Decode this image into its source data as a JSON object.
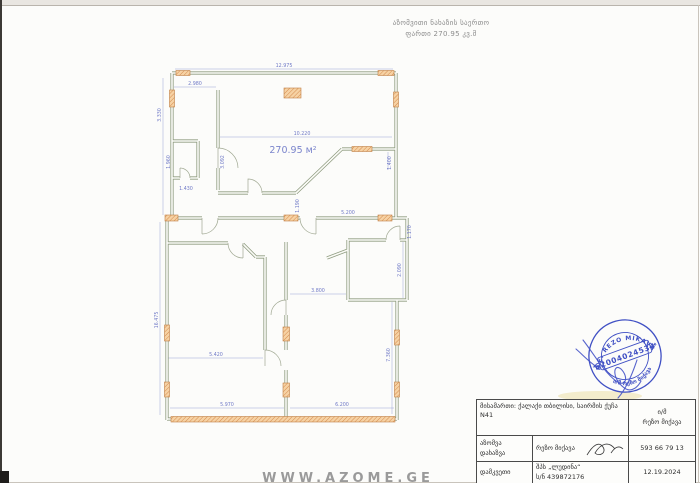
{
  "page": {
    "header_line1": "აზომვითი ნახაზის საერთო",
    "header_line2": "ფართი 270.95 კვ.მ",
    "watermark": "WWW.AZOME.GE"
  },
  "plan": {
    "area_label": "270.95 м²",
    "dims": {
      "d1": "12.975",
      "d2": "2.980",
      "d3": "3.330",
      "d4": "10.220",
      "d5": "1.400",
      "d6": "3.092",
      "d7": "1.960",
      "d8": "1.430",
      "d9": "5.200",
      "d10": "1.190",
      "d11": "16.475",
      "d12": "5.420",
      "d13": "5.970",
      "d14": "6.200",
      "d15": "3.800",
      "d16": "7.360",
      "d17": "2.090",
      "d18": "1.170"
    }
  },
  "stamp": {
    "top_text": "P.E. REZO MIKAVA",
    "number": "62004024534",
    "star": "*",
    "bottom_text": "ი/მ რეზო მიქავა",
    "color": "#4050c4"
  },
  "title_block": {
    "address": "მისამართი: ქალაქი თბილისი, საირმის ქუჩა N41",
    "company_line1": "ი/მ",
    "company_line2": "რეზო მიქავა",
    "measure_label_line1": "აზომვა",
    "measure_label_line2": "დახაზვა",
    "measure_name": "რეზო მიქავა",
    "measure_phone": "593 66 79 13",
    "client_label": "დამკვეთი",
    "client_name": "შპს „ლუდინა“",
    "client_id": "ს/ნ 439872176",
    "client_date": "12.19.2024"
  }
}
